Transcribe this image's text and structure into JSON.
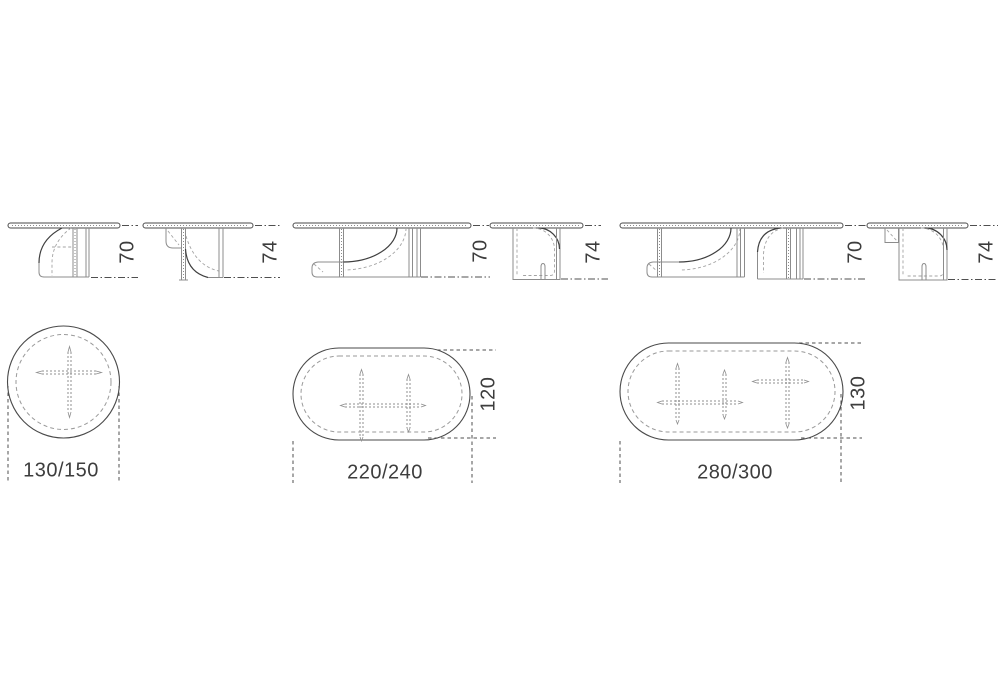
{
  "labels": {
    "elevations": [
      {
        "name": "round-table-front",
        "height": "70"
      },
      {
        "name": "round-table-side",
        "height": "74"
      },
      {
        "name": "oval-table-front",
        "height": "70"
      },
      {
        "name": "oval-table-side",
        "height": "74"
      },
      {
        "name": "large-oval-table-front",
        "height": "70"
      },
      {
        "name": "large-oval-table-side",
        "height": "74"
      }
    ],
    "plans": [
      {
        "name": "round-table-top",
        "width": "130/150"
      },
      {
        "name": "oval-table-top",
        "width": "220/240",
        "depth": "120"
      },
      {
        "name": "large-oval-table-top",
        "width": "280/300",
        "depth": "130"
      }
    ]
  },
  "colors": {
    "background": "#ffffff",
    "outline": "#4a4a4a",
    "line": "#8c8c8c",
    "dark_line": "#3f3f3f",
    "dashed_line": "#9a9a9a",
    "text": "#3d3d3d"
  }
}
